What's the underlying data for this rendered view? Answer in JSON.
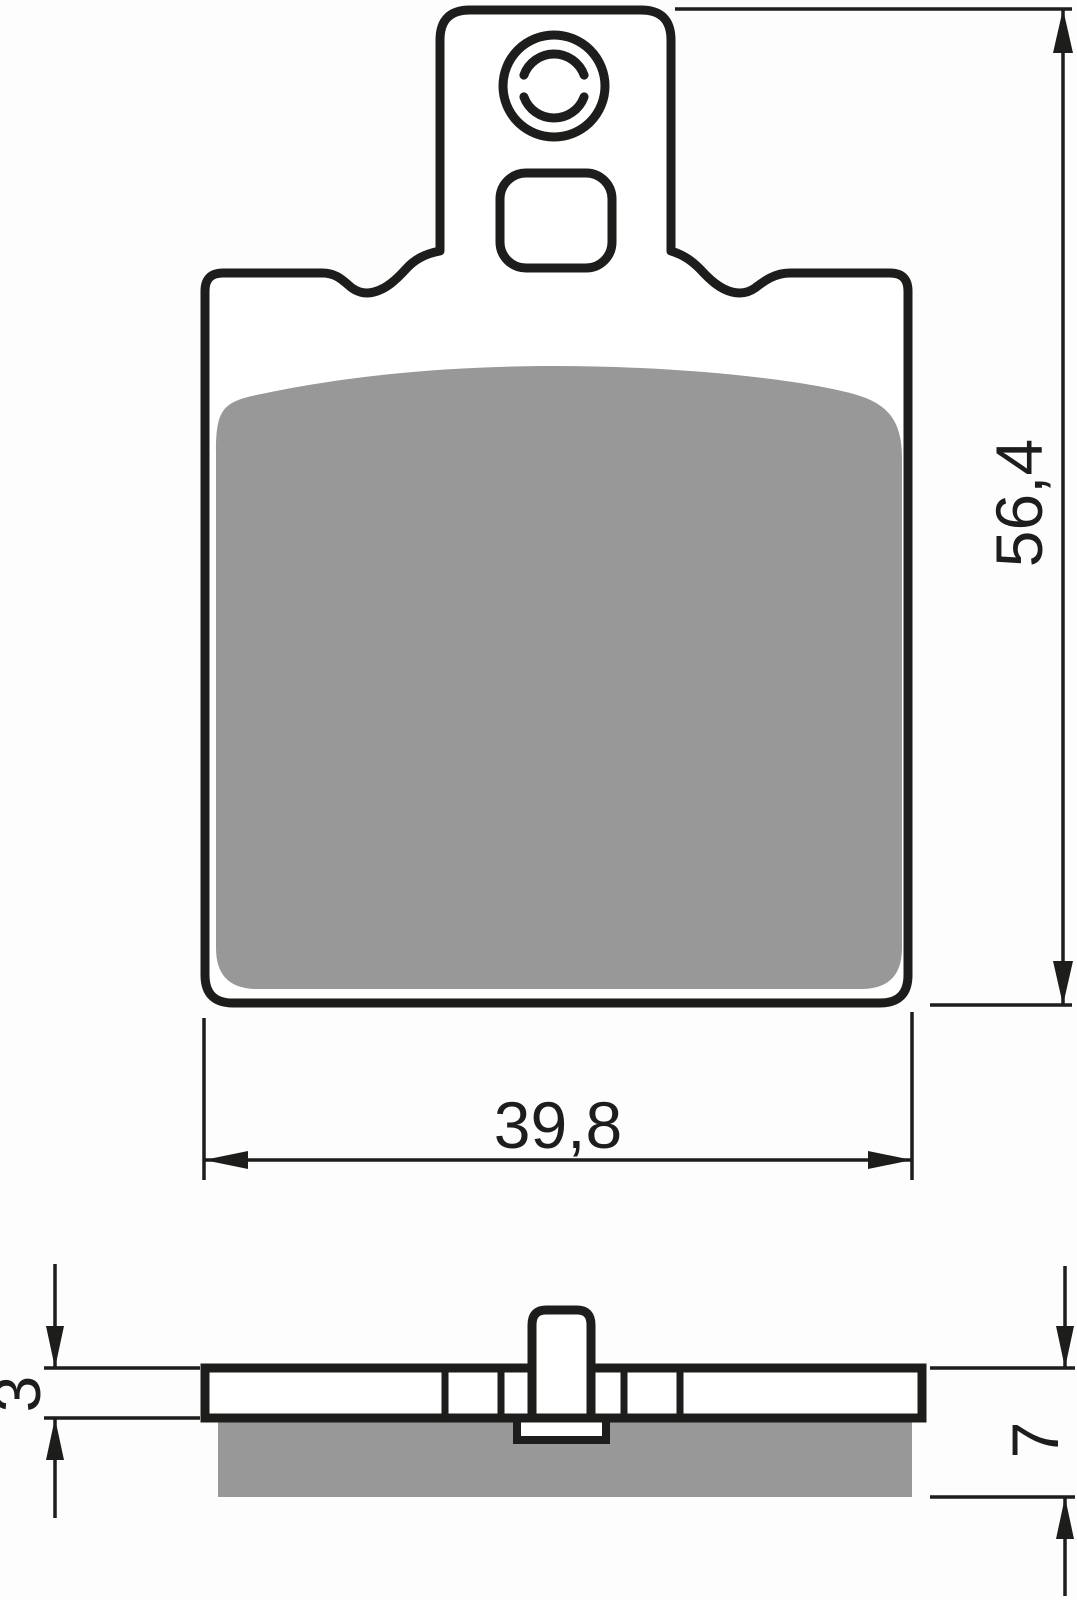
{
  "drawing": {
    "dimensions": {
      "overall_height": "56,4",
      "overall_width": "39,8",
      "backplate_thickness": "3",
      "total_thickness": "7"
    },
    "colors": {
      "outline": "#1d1d1b",
      "friction_material": "#989898",
      "background": "#fdfdfd",
      "part_fill": "#ffffff"
    }
  }
}
